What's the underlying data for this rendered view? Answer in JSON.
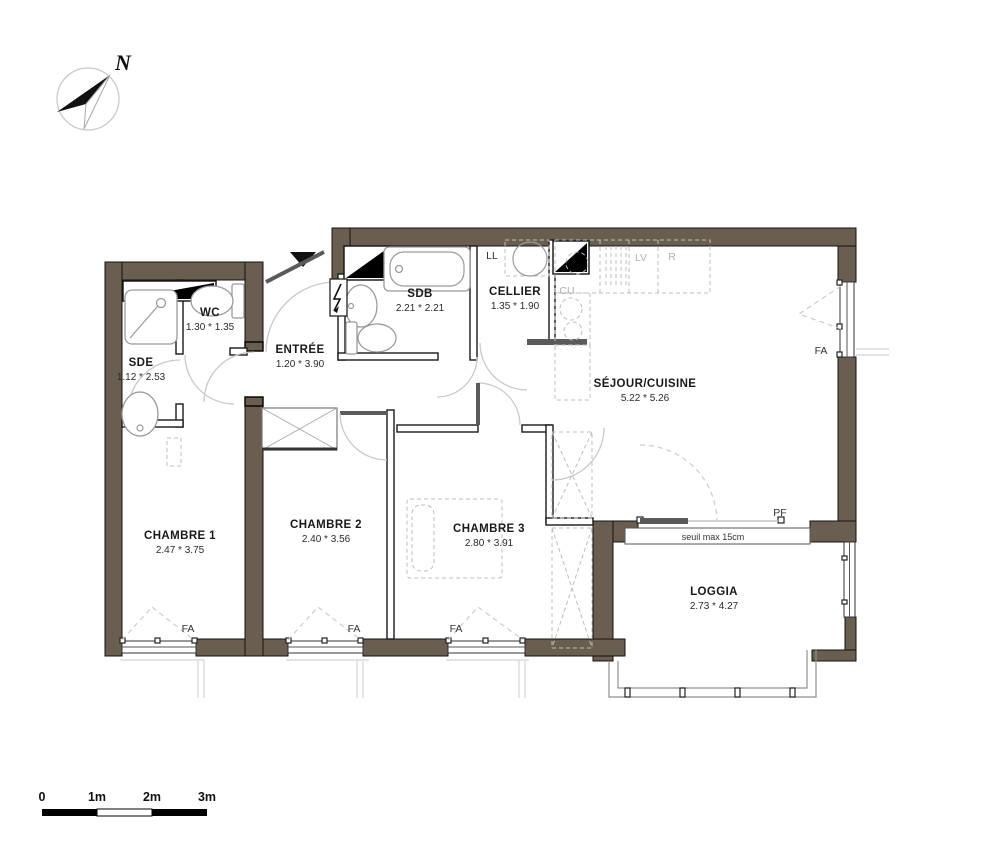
{
  "meta": {
    "drawing_type": "apartment floor plan",
    "wall_color": "#6a5e50",
    "background": "#ffffff"
  },
  "compass": {
    "label": "N"
  },
  "rooms": [
    {
      "id": "wc",
      "name": "WC",
      "dims": "1.30 * 1.35",
      "x": 210,
      "y": 316
    },
    {
      "id": "sde",
      "name": "SDE",
      "dims": "1.12 * 2.53",
      "x": 141,
      "y": 366
    },
    {
      "id": "entree",
      "name": "ENTRÉE",
      "dims": "1.20 * 3.90",
      "x": 300,
      "y": 353
    },
    {
      "id": "sdb",
      "name": "SDB",
      "dims": "2.21 * 2.21",
      "x": 420,
      "y": 297
    },
    {
      "id": "cellier",
      "name": "CELLIER",
      "dims": "1.35 * 1.90",
      "x": 515,
      "y": 295
    },
    {
      "id": "sejour",
      "name": "SÉJOUR/CUISINE",
      "dims": "5.22 * 5.26",
      "x": 645,
      "y": 387
    },
    {
      "id": "chambre1",
      "name": "CHAMBRE 1",
      "dims": "2.47 * 3.75",
      "x": 180,
      "y": 539
    },
    {
      "id": "chambre2",
      "name": "CHAMBRE 2",
      "dims": "2.40 * 3.56",
      "x": 326,
      "y": 528
    },
    {
      "id": "chambre3",
      "name": "CHAMBRE 3",
      "dims": "2.80 * 3.91",
      "x": 489,
      "y": 532
    },
    {
      "id": "loggia",
      "name": "LOGGIA",
      "dims": "2.73 * 4.27",
      "x": 714,
      "y": 595
    }
  ],
  "annotations": [
    {
      "id": "fa-chambre1",
      "text": "FA",
      "x": 188,
      "y": 632,
      "muted": false,
      "small": false
    },
    {
      "id": "fa-chambre2",
      "text": "FA",
      "x": 354,
      "y": 632,
      "muted": false,
      "small": false
    },
    {
      "id": "fa-chambre3",
      "text": "FA",
      "x": 456,
      "y": 632,
      "muted": false,
      "small": false
    },
    {
      "id": "fa-sejour",
      "text": "FA",
      "x": 821,
      "y": 354,
      "muted": false,
      "small": false
    },
    {
      "id": "pf-loggia",
      "text": "PF",
      "x": 780,
      "y": 516,
      "muted": false,
      "small": false
    },
    {
      "id": "ll-cellier",
      "text": "LL",
      "x": 492,
      "y": 259,
      "muted": false,
      "small": false
    },
    {
      "id": "lv-cuisine",
      "text": "LV",
      "x": 641,
      "y": 261,
      "muted": true,
      "small": false
    },
    {
      "id": "r-cuisine",
      "text": "R",
      "x": 672,
      "y": 260,
      "muted": true,
      "small": false
    },
    {
      "id": "cu-cuisine",
      "text": "CU",
      "x": 567,
      "y": 294,
      "muted": true,
      "small": false
    },
    {
      "id": "seuil",
      "text": "seuil max 15cm",
      "x": 713,
      "y": 540,
      "muted": false,
      "small": true
    }
  ],
  "scale_bar": {
    "labels": [
      "0",
      "1m",
      "2m",
      "3m"
    ],
    "positions": [
      42,
      97,
      152,
      207
    ],
    "label_y": 801
  }
}
